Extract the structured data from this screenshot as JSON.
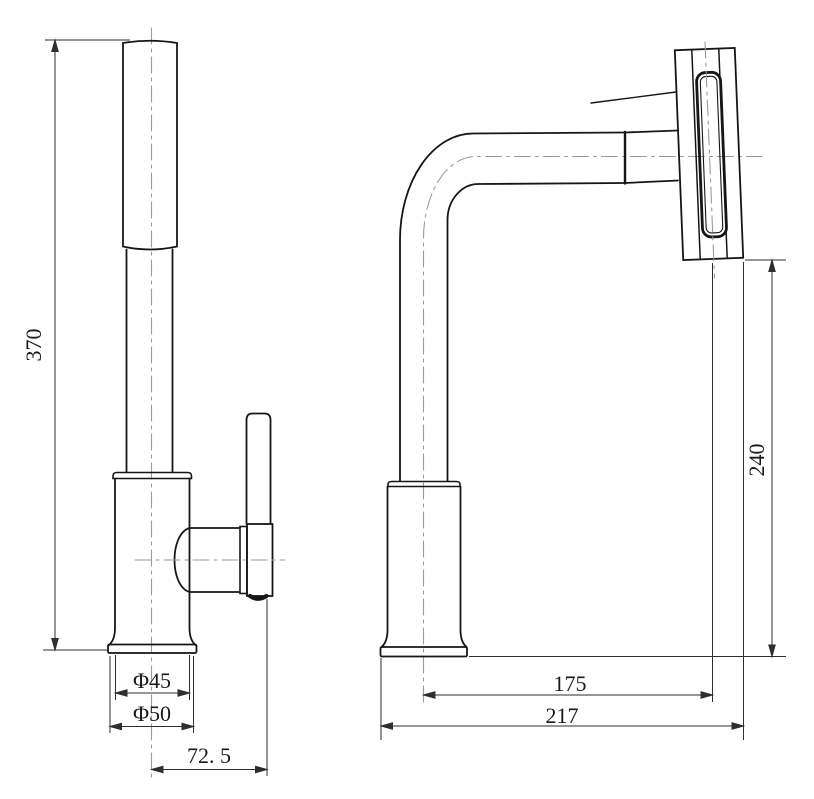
{
  "drawing": {
    "colors": {
      "background": "#ffffff",
      "geometry_line": "#161616",
      "dimension_line": "#2e2e2e",
      "centerline": "#9b9b9b"
    },
    "side_view": {
      "dims": {
        "total_height": {
          "label": "370",
          "value": 370,
          "orientation": "vertical"
        },
        "body_diameter": {
          "label": "Φ45",
          "value": 45,
          "orientation": "horizontal"
        },
        "flange_diameter": {
          "label": "Φ50",
          "value": 50,
          "orientation": "horizontal"
        },
        "handle_offset": {
          "label": "72. 5",
          "value": 72.5,
          "orientation": "horizontal"
        }
      }
    },
    "front_view": {
      "dims": {
        "spout_reach_center": {
          "label": "175",
          "value": 175,
          "orientation": "horizontal"
        },
        "spout_reach_overall": {
          "label": "217",
          "value": 217,
          "orientation": "horizontal"
        },
        "spout_height": {
          "label": "240",
          "value": 240,
          "orientation": "vertical"
        }
      }
    }
  }
}
